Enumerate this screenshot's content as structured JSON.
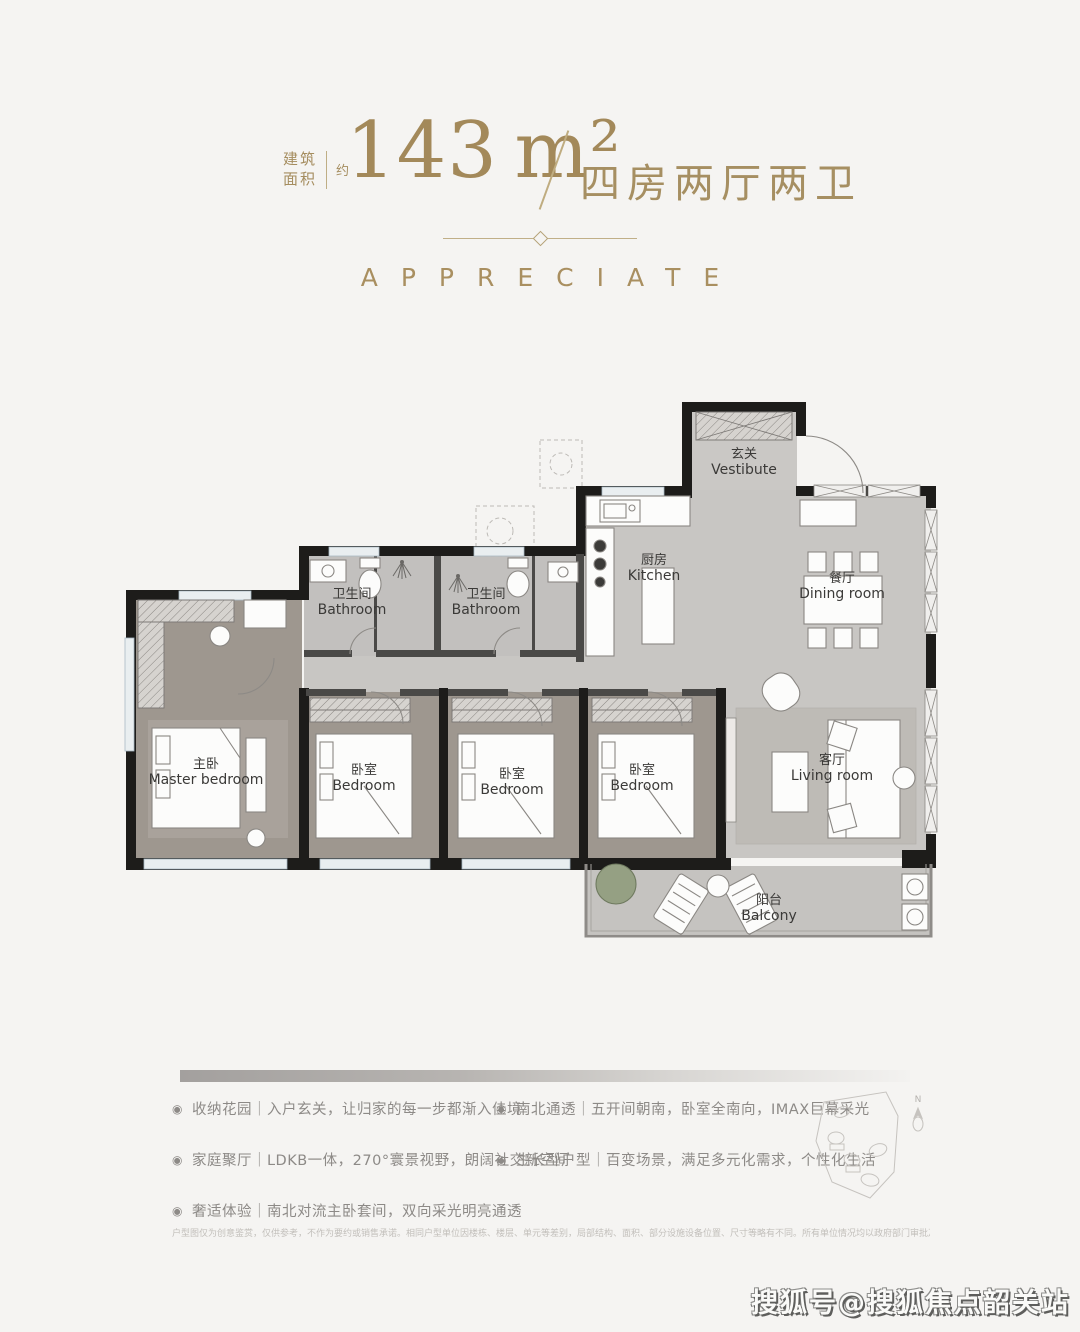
{
  "header": {
    "area_label_line1": "建筑",
    "area_label_line2": "面积",
    "area_approx": "约",
    "area_value": "143",
    "area_unit": "m²",
    "layout_text": "四房两厅两卫",
    "accent_color": "#a3895a"
  },
  "section_title": "APPRECIATE",
  "plan": {
    "rooms": [
      {
        "zh": "玄关",
        "en": "Vestibute"
      },
      {
        "zh": "厨房",
        "en": "Kitchen"
      },
      {
        "zh": "餐厅",
        "en": "Dining room"
      },
      {
        "zh": "卫生间",
        "en": "Bathroom"
      },
      {
        "zh": "卫生间",
        "en": "Bathroom"
      },
      {
        "zh": "主卧",
        "en": "Master bedroom"
      },
      {
        "zh": "卧室",
        "en": "Bedroom"
      },
      {
        "zh": "卧室",
        "en": "Bedroom"
      },
      {
        "zh": "卧室",
        "en": "Bedroom"
      },
      {
        "zh": "客厅",
        "en": "Living room"
      },
      {
        "zh": "阳台",
        "en": "Balcony"
      }
    ],
    "compass_label": "N",
    "wall_color": "#1d1c1a",
    "marble_floor_color": "#c8c6c3",
    "wood_floor_color": "#9e978f",
    "window_color": "#e9eef0"
  },
  "features": {
    "bullet": "◉",
    "left": [
      "收纳花园｜入户玄关，让归家的每一步都渐入佳境",
      "家庭聚厅｜LDKB一体，270°寰景视野，朗阔社交新空间",
      "奢适体验｜南北对流主卧套间，双向采光明亮通透"
    ],
    "right": [
      "南北通透｜五开间朝南，卧室全南向，IMAX巨幕采光",
      "生长型户型｜百变场景，满足多元化需求，个性化生活"
    ]
  },
  "disclaimer": "户型图仅为创意鉴赏，仅供参考，不作为要约或销售承诺。相同户型单位因楼栋、楼层、单元等差别，局部结构、面积、部分设施设备位置、尺寸等略有不同。所有单位情况均以政府部门审批及双方签订商品房买卖合同的定为准。",
  "watermark": "搜狐号@搜狐焦点韶关站"
}
